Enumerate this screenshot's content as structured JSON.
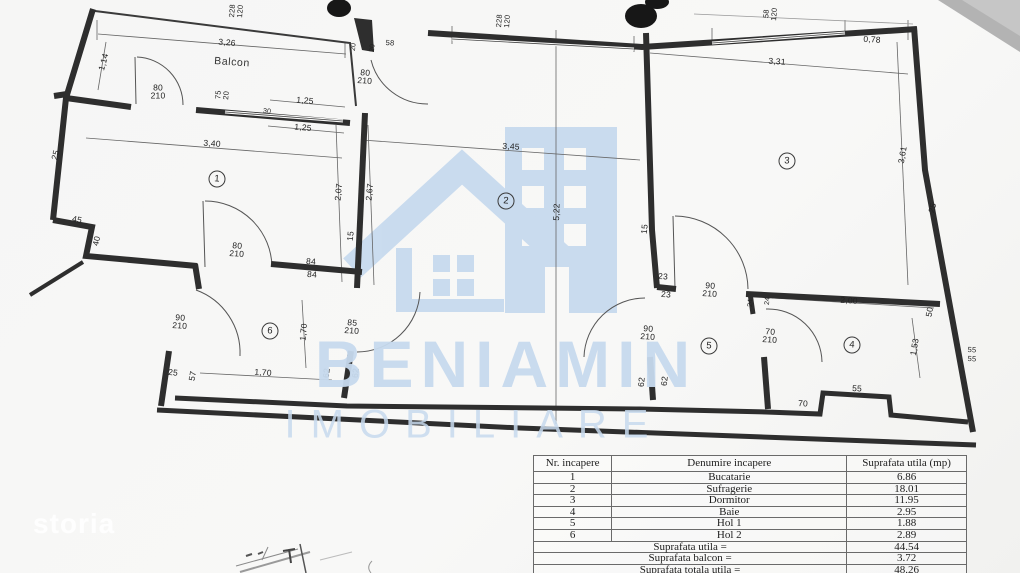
{
  "watermark": {
    "line1": "BENIAMIN",
    "line2": "IMOBILIARE",
    "color": "#c7daee"
  },
  "corner_brand": "storia",
  "plan": {
    "balcony_label": {
      "t": "Balcon",
      "x": 232,
      "y": 63,
      "r": 4
    },
    "rooms": [
      {
        "n": "1",
        "x": 217,
        "y": 179
      },
      {
        "n": "2",
        "x": 506,
        "y": 201
      },
      {
        "n": "3",
        "x": 787,
        "y": 161
      },
      {
        "n": "4",
        "x": 852,
        "y": 345
      },
      {
        "n": "5",
        "x": 709,
        "y": 346
      },
      {
        "n": "6",
        "x": 270,
        "y": 331
      }
    ],
    "labels": [
      {
        "t": "228\n120",
        "x": 236,
        "y": 11,
        "r": -86,
        "fs": 7.5
      },
      {
        "t": "3,26",
        "x": 227,
        "y": 43,
        "r": 5
      },
      {
        "t": "1,14",
        "x": 104,
        "y": 62,
        "r": -75
      },
      {
        "t": "80\n210",
        "x": 158,
        "y": 92,
        "r": 0
      },
      {
        "t": "75\n20",
        "x": 222,
        "y": 95,
        "r": -86,
        "fs": 7.5
      },
      {
        "t": "1,25",
        "x": 305,
        "y": 101,
        "r": 5
      },
      {
        "t": "30",
        "x": 267,
        "y": 112,
        "r": 5,
        "fs": 7
      },
      {
        "t": "1,25",
        "x": 303,
        "y": 128,
        "r": 5
      },
      {
        "t": "20",
        "x": 354,
        "y": 47,
        "r": -85,
        "fs": 7
      },
      {
        "t": "20",
        "x": 373,
        "y": 48,
        "r": -85,
        "fs": 7
      },
      {
        "t": "58",
        "x": 390,
        "y": 43,
        "r": 4,
        "fs": 7.5
      },
      {
        "t": "80\n210",
        "x": 365,
        "y": 77,
        "r": 4
      },
      {
        "t": "228\n120",
        "x": 503,
        "y": 21,
        "r": -86,
        "fs": 7.5
      },
      {
        "t": "58\n120",
        "x": 770,
        "y": 14,
        "r": -86,
        "fs": 7.5
      },
      {
        "t": "0,78",
        "x": 872,
        "y": 40,
        "r": 3
      },
      {
        "t": "3,31",
        "x": 777,
        "y": 62,
        "r": 4
      },
      {
        "t": "25",
        "x": 56,
        "y": 155,
        "r": -75
      },
      {
        "t": "3,40",
        "x": 212,
        "y": 144,
        "r": 4
      },
      {
        "t": "3,45",
        "x": 511,
        "y": 147,
        "r": 3
      },
      {
        "t": "2,07",
        "x": 339,
        "y": 192,
        "r": -85
      },
      {
        "t": "2,67",
        "x": 370,
        "y": 192,
        "r": -85
      },
      {
        "t": "5,22",
        "x": 557,
        "y": 212,
        "r": -88
      },
      {
        "t": "3,61",
        "x": 903,
        "y": 155,
        "r": -80
      },
      {
        "t": "25",
        "x": 933,
        "y": 208,
        "r": -75
      },
      {
        "t": "15",
        "x": 351,
        "y": 236,
        "r": -85
      },
      {
        "t": "15",
        "x": 645,
        "y": 229,
        "r": -85
      },
      {
        "t": "45",
        "x": 77,
        "y": 220,
        "r": 10
      },
      {
        "t": "40",
        "x": 97,
        "y": 241,
        "r": -78
      },
      {
        "t": "80\n210",
        "x": 237,
        "y": 250,
        "r": 4
      },
      {
        "t": "84",
        "x": 311,
        "y": 262,
        "r": 4
      },
      {
        "t": "84",
        "x": 312,
        "y": 275,
        "r": 4
      },
      {
        "t": "23",
        "x": 663,
        "y": 277,
        "r": 4
      },
      {
        "t": "23",
        "x": 666,
        "y": 295,
        "r": 4
      },
      {
        "t": "90\n210",
        "x": 710,
        "y": 290,
        "r": 4
      },
      {
        "t": "24",
        "x": 751,
        "y": 303,
        "r": -85,
        "fs": 7
      },
      {
        "t": "24",
        "x": 768,
        "y": 301,
        "r": -85,
        "fs": 7
      },
      {
        "t": "2,00",
        "x": 849,
        "y": 301,
        "r": 3
      },
      {
        "t": "50",
        "x": 930,
        "y": 312,
        "r": -80
      },
      {
        "t": "90\n210",
        "x": 180,
        "y": 322,
        "r": 4
      },
      {
        "t": "1,70",
        "x": 304,
        "y": 332,
        "r": -85
      },
      {
        "t": "85\n210",
        "x": 352,
        "y": 327,
        "r": 4
      },
      {
        "t": "25",
        "x": 173,
        "y": 373,
        "r": 6
      },
      {
        "t": "57",
        "x": 193,
        "y": 376,
        "r": -80
      },
      {
        "t": "1,70",
        "x": 263,
        "y": 373,
        "r": 4
      },
      {
        "t": "62",
        "x": 327,
        "y": 373,
        "r": -85
      },
      {
        "t": "62",
        "x": 356,
        "y": 373,
        "r": -85
      },
      {
        "t": "90\n210",
        "x": 648,
        "y": 333,
        "r": 4
      },
      {
        "t": "70\n210",
        "x": 770,
        "y": 336,
        "r": 4
      },
      {
        "t": "62",
        "x": 642,
        "y": 382,
        "r": -85
      },
      {
        "t": "62",
        "x": 665,
        "y": 381,
        "r": -85
      },
      {
        "t": "1,53",
        "x": 915,
        "y": 347,
        "r": -80
      },
      {
        "t": "55",
        "x": 857,
        "y": 389,
        "r": 3
      },
      {
        "t": "70",
        "x": 803,
        "y": 404,
        "r": 3
      },
      {
        "t": "55",
        "x": 972,
        "y": 350,
        "r": 3,
        "fs": 7.5
      },
      {
        "t": "55",
        "x": 972,
        "y": 359,
        "r": 3,
        "fs": 7.5
      }
    ]
  },
  "areas_table": {
    "headers": [
      "Nr. incapere",
      "Denumire incapere",
      "Suprafata utila (mp)"
    ],
    "rows": [
      {
        "nr": "1",
        "name": "Bucatarie",
        "area": "6.86"
      },
      {
        "nr": "2",
        "name": "Sufragerie",
        "area": "18.01"
      },
      {
        "nr": "3",
        "name": "Dormitor",
        "area": "11.95"
      },
      {
        "nr": "4",
        "name": "Baie",
        "area": "2.95"
      },
      {
        "nr": "5",
        "name": "Hol 1",
        "area": "1.88"
      },
      {
        "nr": "6",
        "name": "Hol 2",
        "area": "2.89"
      }
    ],
    "totals": [
      {
        "label": "Suprafata utila =",
        "value": "44.54"
      },
      {
        "label": "Suprafata balcon =",
        "value": "3.72"
      },
      {
        "label": "Suprafata totala utila =",
        "value": "48.26"
      }
    ]
  }
}
